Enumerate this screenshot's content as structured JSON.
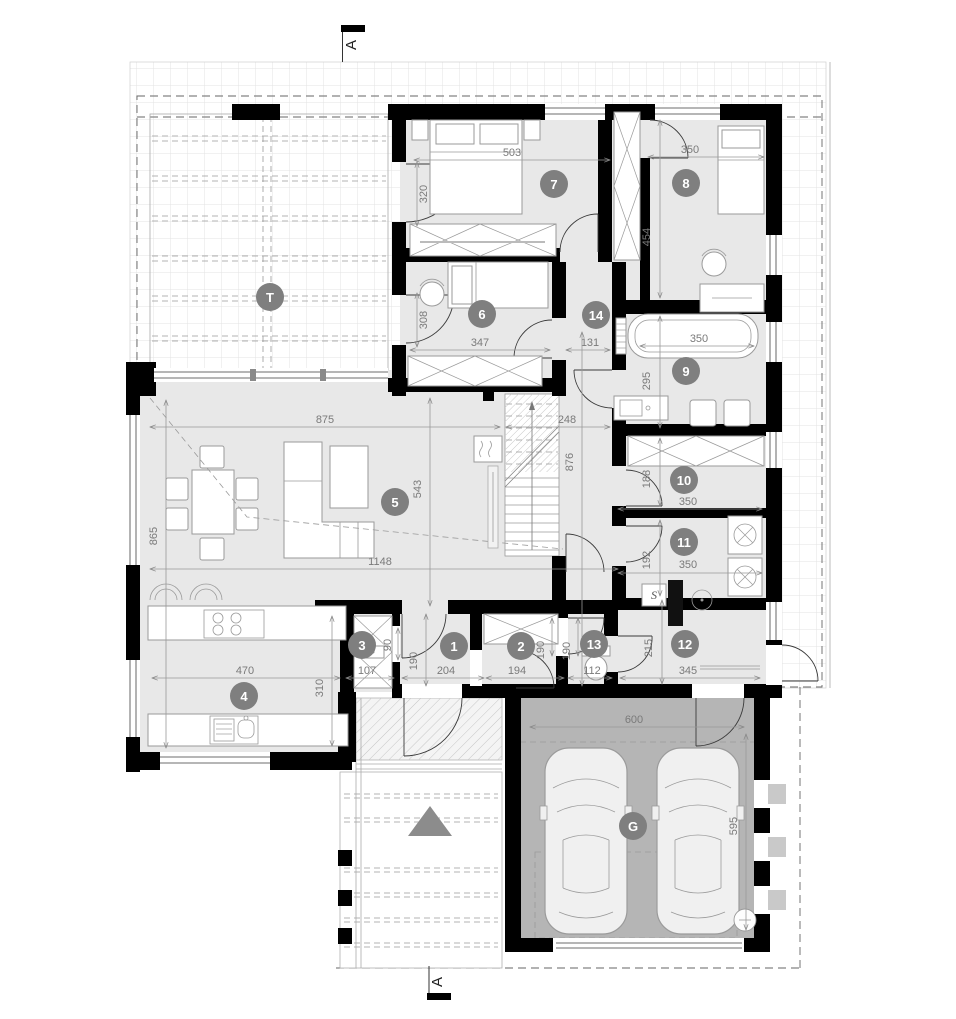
{
  "drawing": {
    "type": "architectural floor plan",
    "section_markers": {
      "top": "A",
      "bottom": "A"
    }
  },
  "colors": {
    "wall": "#000000",
    "room_floor": "#e8e8e8",
    "garage_floor": "#b5b5b5",
    "label_circle": "#7f7f7f",
    "label_text": "#ffffff",
    "dim_text": "#7a7a7a",
    "dashed_line": "#666666",
    "arrow_triangle": "#8c8c8c"
  },
  "room_labels": {
    "terrace": "T",
    "garage": "G",
    "r1": "1",
    "r2": "2",
    "r3": "3",
    "r4": "4",
    "r5": "5",
    "r6": "6",
    "r7": "7",
    "r8": "8",
    "r9": "9",
    "r10": "10",
    "r11": "11",
    "r12": "12",
    "r13": "13",
    "r14": "14"
  },
  "dimensions": {
    "room7_width": "503",
    "room8_width": "350",
    "room7_door": "320",
    "room8_depth": "454",
    "room6_door": "308",
    "room6_width": "347",
    "hall_width": "131",
    "bath_width": "350",
    "bath_depth": "295",
    "living_width": "875",
    "stair_width": "248",
    "living_depth": "543",
    "corridor_length": "876",
    "living_side_depth": "865",
    "living_total_width": "1148",
    "room10_depth": "188",
    "room10_width": "350",
    "room11_depth": "192",
    "room11_width": "350",
    "kitchen_width": "470",
    "kitchen_depth": "310",
    "room3_width": "107",
    "room3_door": "90",
    "room1_depth": "190",
    "room1_width": "204",
    "room2_width": "194",
    "room2_door": "190",
    "room13_door": "190",
    "room13_width": "112",
    "room12_depth": "215",
    "room12_width": "345",
    "garage_width": "600",
    "garage_depth": "595"
  },
  "symbols": {
    "gas_appliance": "S"
  }
}
